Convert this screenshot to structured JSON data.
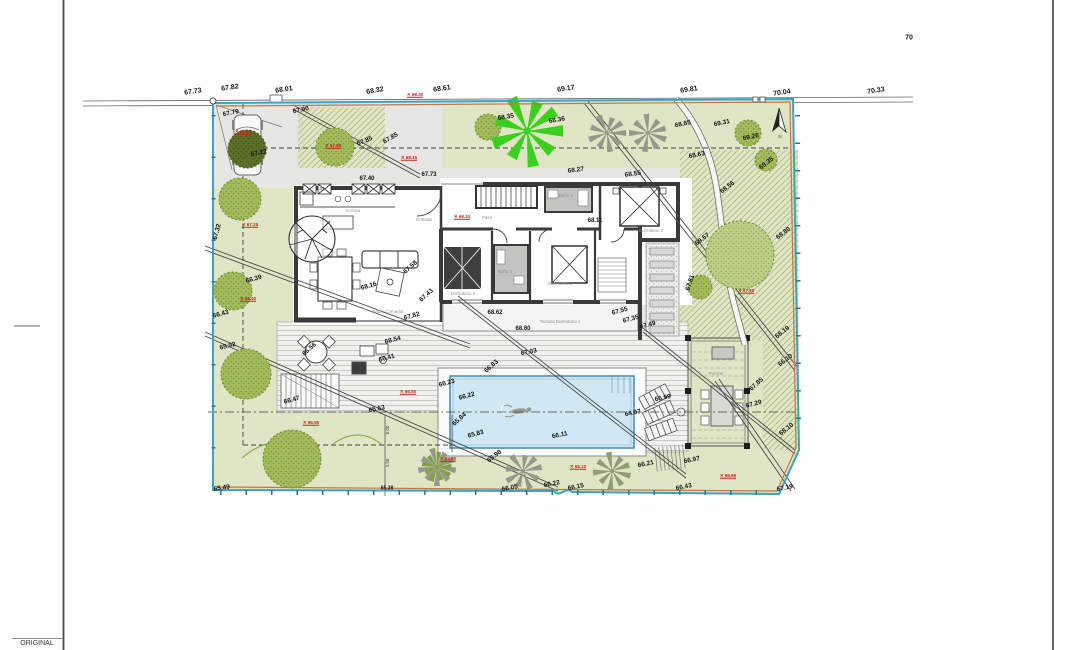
{
  "meta": {
    "original_label": "ORIGINAL"
  },
  "colors": {
    "lawn": "#dfe5c5",
    "hatch_line": "#a8b274",
    "paving": "#e6e6e3",
    "deck_bg": "#f1f1ee",
    "deck_line": "#c9c9c4",
    "pool_water": "#cfe8f4",
    "pool_edge": "#418bb0",
    "wall": "#3a3a3a",
    "boundary_blue": "#3aa3c8",
    "boundary_orange": "#c5763b",
    "survey_red": "#c3261a",
    "tree_green": "#a3bd5c",
    "tree_light": "#bdcf86",
    "tree_dark": "#5c7029",
    "palm_gray": "#97978b",
    "palm_bright": "#3bd01f"
  },
  "labels": [
    {
      "g": "road",
      "t": "67.73",
      "x": 193,
      "y": 92,
      "r": -8
    },
    {
      "g": "road",
      "t": "67.82",
      "x": 230,
      "y": 88,
      "r": -8
    },
    {
      "g": "road",
      "t": "68.01",
      "x": 284,
      "y": 90,
      "r": -8
    },
    {
      "g": "road",
      "t": "68.32",
      "x": 375,
      "y": 91,
      "r": -10
    },
    {
      "g": "road",
      "t": "68.61",
      "x": 442,
      "y": 89,
      "r": -8
    },
    {
      "g": "road",
      "t": "69.17",
      "x": 566,
      "y": 89,
      "r": -8
    },
    {
      "g": "road",
      "t": "69.81",
      "x": 689,
      "y": 90,
      "r": -8
    },
    {
      "g": "road",
      "t": "70.04",
      "x": 782,
      "y": 93,
      "r": -8
    },
    {
      "g": "road",
      "t": "70.33",
      "x": 876,
      "y": 91,
      "r": -8
    },
    {
      "g": "road",
      "t": "70",
      "x": 909,
      "y": 38,
      "r": 0
    },
    {
      "g": "site",
      "t": "67.79",
      "x": 231,
      "y": 114,
      "r": -12
    },
    {
      "g": "site",
      "t": "67.90",
      "x": 301,
      "y": 111,
      "r": -12
    },
    {
      "g": "site",
      "t": "67.22",
      "x": 259,
      "y": 154,
      "r": -12
    },
    {
      "g": "site",
      "t": "67.85",
      "x": 365,
      "y": 142,
      "r": -22
    },
    {
      "g": "site",
      "t": "67.85",
      "x": 391,
      "y": 139,
      "r": -30
    },
    {
      "g": "site",
      "t": "67.40",
      "x": 367,
      "y": 179,
      "r": 0,
      "s": 6
    },
    {
      "g": "site",
      "t": "67.73",
      "x": 429,
      "y": 175,
      "r": 0,
      "s": 6
    },
    {
      "g": "site",
      "t": "68.35",
      "x": 506,
      "y": 118,
      "r": -10
    },
    {
      "g": "site",
      "t": "68.36",
      "x": 557,
      "y": 121,
      "r": -10
    },
    {
      "g": "site",
      "t": "68.85",
      "x": 683,
      "y": 125,
      "r": -12
    },
    {
      "g": "site",
      "t": "69.31",
      "x": 722,
      "y": 124,
      "r": -12
    },
    {
      "g": "site",
      "t": "69.26",
      "x": 751,
      "y": 138,
      "r": -12
    },
    {
      "g": "site",
      "t": "69.35",
      "x": 767,
      "y": 164,
      "r": -38
    },
    {
      "g": "site",
      "t": "68.63",
      "x": 697,
      "y": 156,
      "r": -12
    },
    {
      "g": "site",
      "t": "68.56",
      "x": 728,
      "y": 188,
      "r": -38
    },
    {
      "g": "site",
      "t": "68.27",
      "x": 576,
      "y": 171,
      "r": -8
    },
    {
      "g": "site",
      "t": "68.55",
      "x": 633,
      "y": 175,
      "r": -8
    },
    {
      "g": "site",
      "t": "68.11",
      "x": 595,
      "y": 221,
      "r": 0,
      "s": 6
    },
    {
      "g": "site",
      "t": "69.57",
      "x": 703,
      "y": 240,
      "r": -38
    },
    {
      "g": "site",
      "t": "68.80",
      "x": 784,
      "y": 234,
      "r": -38
    },
    {
      "g": "site",
      "t": "67.81",
      "x": 691,
      "y": 283,
      "r": -72
    },
    {
      "g": "site",
      "t": "68.19",
      "x": 783,
      "y": 333,
      "r": -38
    },
    {
      "g": "site",
      "t": "66.10",
      "x": 786,
      "y": 361,
      "r": -38
    },
    {
      "g": "site",
      "t": "68.10",
      "x": 787,
      "y": 430,
      "r": -38
    },
    {
      "g": "site",
      "t": "67.85",
      "x": 757,
      "y": 385,
      "r": -42
    },
    {
      "g": "site",
      "t": "67.29",
      "x": 754,
      "y": 405,
      "r": -15
    },
    {
      "g": "site",
      "t": "67.55",
      "x": 620,
      "y": 312,
      "r": -15
    },
    {
      "g": "site",
      "t": "67.35",
      "x": 631,
      "y": 320,
      "r": -15
    },
    {
      "g": "site",
      "t": "67.49",
      "x": 648,
      "y": 326,
      "r": -15
    },
    {
      "g": "site",
      "t": "67.32",
      "x": 218,
      "y": 232,
      "r": -75
    },
    {
      "g": "site",
      "t": "66.43",
      "x": 221,
      "y": 315,
      "r": -15
    },
    {
      "g": "site",
      "t": "65.92",
      "x": 228,
      "y": 347,
      "r": -14
    },
    {
      "g": "site",
      "t": "66.39",
      "x": 254,
      "y": 280,
      "r": -15
    },
    {
      "g": "site",
      "t": "65.49",
      "x": 222,
      "y": 489,
      "r": -10
    },
    {
      "g": "site",
      "t": "67.58",
      "x": 411,
      "y": 268,
      "r": -42
    },
    {
      "g": "site",
      "t": "68.16",
      "x": 369,
      "y": 287,
      "r": -15
    },
    {
      "g": "site",
      "t": "67.43",
      "x": 427,
      "y": 296,
      "r": -42
    },
    {
      "g": "site",
      "t": "67.82",
      "x": 412,
      "y": 317,
      "r": -15
    },
    {
      "g": "site",
      "t": "68.54",
      "x": 393,
      "y": 341,
      "r": -15
    },
    {
      "g": "site",
      "t": "66.41",
      "x": 387,
      "y": 359,
      "r": -15
    },
    {
      "g": "site",
      "t": "66.56",
      "x": 310,
      "y": 350,
      "r": -42
    },
    {
      "g": "site",
      "t": "66.47",
      "x": 292,
      "y": 401,
      "r": -15
    },
    {
      "g": "site",
      "t": "68.62",
      "x": 495,
      "y": 313,
      "r": 0,
      "s": 6
    },
    {
      "g": "site",
      "t": "68.60",
      "x": 523,
      "y": 329,
      "r": 0,
      "s": 6
    },
    {
      "g": "site",
      "t": "67.03",
      "x": 529,
      "y": 353,
      "r": -12
    },
    {
      "g": "site",
      "t": "66.83",
      "x": 492,
      "y": 367,
      "r": -42
    },
    {
      "g": "site",
      "t": "66.23",
      "x": 447,
      "y": 384,
      "r": -15
    },
    {
      "g": "site",
      "t": "66.22",
      "x": 467,
      "y": 397,
      "r": -15
    },
    {
      "g": "site",
      "t": "65.84",
      "x": 460,
      "y": 420,
      "r": -42
    },
    {
      "g": "site",
      "t": "65.83",
      "x": 476,
      "y": 435,
      "r": -15
    },
    {
      "g": "site",
      "t": "66.11",
      "x": 560,
      "y": 436,
      "r": -12
    },
    {
      "g": "site",
      "t": "64.97",
      "x": 633,
      "y": 414,
      "r": -12
    },
    {
      "g": "site",
      "t": "66.99",
      "x": 663,
      "y": 399,
      "r": -12
    },
    {
      "g": "site",
      "t": "65.63",
      "x": 377,
      "y": 410,
      "r": -12
    },
    {
      "g": "site",
      "t": "65.98",
      "x": 495,
      "y": 457,
      "r": -38
    },
    {
      "g": "site",
      "t": "66.05",
      "x": 510,
      "y": 489,
      "r": -12
    },
    {
      "g": "site",
      "t": "66.22",
      "x": 552,
      "y": 485,
      "r": -12
    },
    {
      "g": "site",
      "t": "66.15",
      "x": 576,
      "y": 488,
      "r": -12
    },
    {
      "g": "site",
      "t": "65.38",
      "x": 387,
      "y": 489,
      "r": 0,
      "s": 5
    },
    {
      "g": "site",
      "t": "66.21",
      "x": 646,
      "y": 465,
      "r": -12
    },
    {
      "g": "site",
      "t": "66.97",
      "x": 692,
      "y": 461,
      "r": -12
    },
    {
      "g": "site",
      "t": "66.43",
      "x": 684,
      "y": 488,
      "r": -12
    },
    {
      "g": "site",
      "t": "67.19",
      "x": 785,
      "y": 489,
      "r": -12
    },
    {
      "g": "rooms",
      "t": "Cocina",
      "x": 353,
      "y": 211,
      "r": 0
    },
    {
      "g": "rooms",
      "t": "Entrada",
      "x": 424,
      "y": 220,
      "r": 0
    },
    {
      "g": "rooms",
      "t": "Paso",
      "x": 487,
      "y": 218,
      "r": 0
    },
    {
      "g": "rooms",
      "t": "Baño 1",
      "x": 566,
      "y": 196,
      "r": 0
    },
    {
      "g": "rooms",
      "t": "Baño 2",
      "x": 505,
      "y": 272,
      "r": 0
    },
    {
      "g": "rooms",
      "t": "Dormitorio 1",
      "x": 651,
      "y": 231,
      "r": 0
    },
    {
      "g": "rooms",
      "t": "Dormitorio 2",
      "x": 463,
      "y": 294,
      "r": 0
    },
    {
      "g": "rooms",
      "t": "Dormitorio 3",
      "x": 560,
      "y": 284,
      "r": 0
    },
    {
      "g": "rooms",
      "t": "Salón Comedor",
      "x": 388,
      "y": 312,
      "r": 0
    },
    {
      "g": "rooms",
      "t": "Terraza Dormitorio 1",
      "x": 560,
      "y": 322,
      "r": 0
    },
    {
      "g": "rooms",
      "t": "Porche",
      "x": 716,
      "y": 374,
      "r": 0
    },
    {
      "g": "dims",
      "t": "5.47",
      "x": 320,
      "y": 189,
      "r": 0
    },
    {
      "g": "dims",
      "t": "5.00",
      "x": 388,
      "y": 430,
      "r": -90
    },
    {
      "g": "dims",
      "t": "3.50",
      "x": 388,
      "y": 463,
      "r": -90
    },
    {
      "g": "dims",
      "t": "N",
      "x": 780,
      "y": 137,
      "r": 0
    },
    {
      "g": "red",
      "t": "68.30",
      "x": 415,
      "y": 95,
      "r": 0
    },
    {
      "g": "red",
      "t": "67.95",
      "x": 243,
      "y": 132,
      "r": 0
    },
    {
      "g": "red",
      "t": "67.88",
      "x": 333,
      "y": 146,
      "r": 0
    },
    {
      "g": "red",
      "t": "68.15",
      "x": 409,
      "y": 158,
      "r": 0
    },
    {
      "g": "red",
      "t": "68.10",
      "x": 462,
      "y": 217,
      "r": 0
    },
    {
      "g": "red",
      "t": "67.25",
      "x": 250,
      "y": 225,
      "r": 0
    },
    {
      "g": "red",
      "t": "66.40",
      "x": 248,
      "y": 299,
      "r": 0
    },
    {
      "g": "red",
      "t": "65.95",
      "x": 311,
      "y": 423,
      "r": 0
    },
    {
      "g": "red",
      "t": "66.50",
      "x": 408,
      "y": 392,
      "r": 0
    },
    {
      "g": "red",
      "t": "65.90",
      "x": 448,
      "y": 459,
      "r": 0
    },
    {
      "g": "red",
      "t": "66.10",
      "x": 578,
      "y": 467,
      "r": 0
    },
    {
      "g": "red",
      "t": "66.95",
      "x": 728,
      "y": 476,
      "r": 0
    },
    {
      "g": "red",
      "t": "67.80",
      "x": 746,
      "y": 291,
      "r": 0
    }
  ]
}
